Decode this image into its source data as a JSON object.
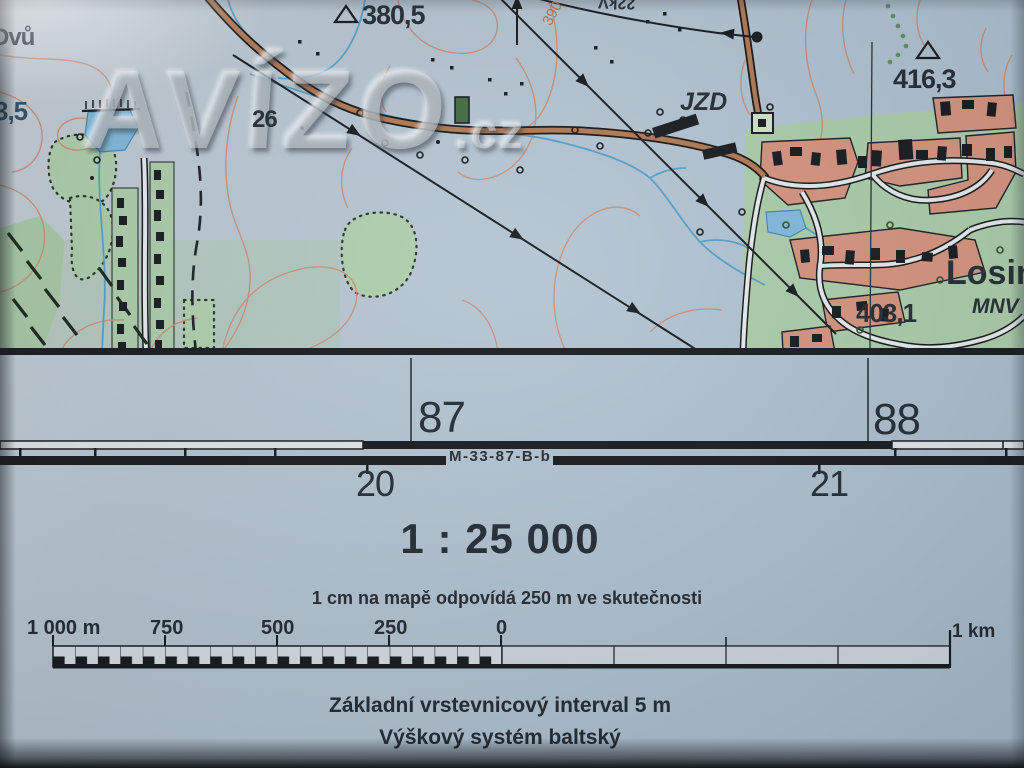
{
  "watermark": {
    "name": "AVÍZO",
    "tld": ".cz"
  },
  "map_labels": {
    "settlement_left": "Dvů",
    "water_value": "3,5",
    "trig_height_1": "380,5",
    "trig_height_2": "416,3",
    "spot_height": "403,1",
    "farm": "JZD",
    "road_number": "26",
    "settlement_right": "Losin",
    "authority": "MNV",
    "contour_value": "390",
    "powerline_voltage": "22kV"
  },
  "margin": {
    "grid_easting_left": "87",
    "grid_easting_right": "88",
    "sheet_code": "M-33-87-B-b",
    "minute_left": "20",
    "minute_right": "21"
  },
  "scale_block": {
    "ratio": "1 : 25 000",
    "equivalence": "1 cm na mapě odpovídá 250 m ve skutečnosti",
    "bar_labels": [
      "1 000 m",
      "750",
      "500",
      "250",
      "0",
      "1 km"
    ],
    "contour_interval_note": "Základní vrstevnicový interval 5 m",
    "height_system_note": "Výškový systém baltský"
  },
  "colors": {
    "paper": "#b7c6d3",
    "contour": "#cd8a6e",
    "road_fill": "#b5764f",
    "water": "#5b9fc9",
    "vegetation": "#abcfa9",
    "builtup": "#d8917b",
    "ink": "#1c232e"
  }
}
